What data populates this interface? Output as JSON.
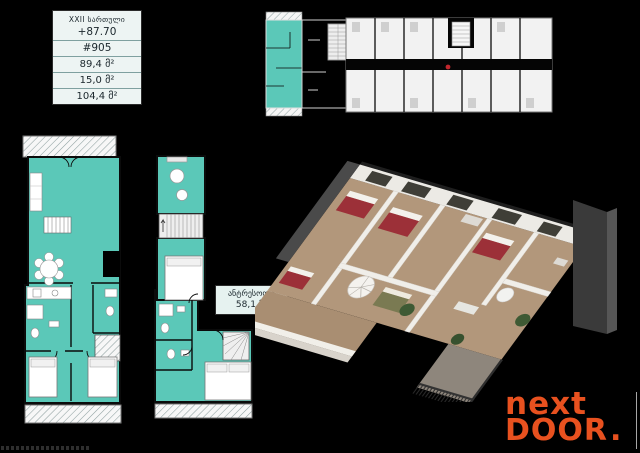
{
  "info_panel": {
    "floor_label": "XXII სართული",
    "elevation": "+87.70",
    "unit_number": "#905",
    "rows": [
      "89,4 მ²",
      "15,0 მ²",
      "104,4 მ²"
    ]
  },
  "mezzanine_label": {
    "title": "ანტრესოლი",
    "area": "58,1 მ²"
  },
  "logo": {
    "word_top": "next",
    "word_bottom": "DOOR",
    "period": "."
  },
  "colors": {
    "background": "#000000",
    "accent_teal": "#5bc8b8",
    "logo_orange": "#e8511f",
    "bed_red": "#9c3038",
    "marker_red": "#c1272d"
  }
}
